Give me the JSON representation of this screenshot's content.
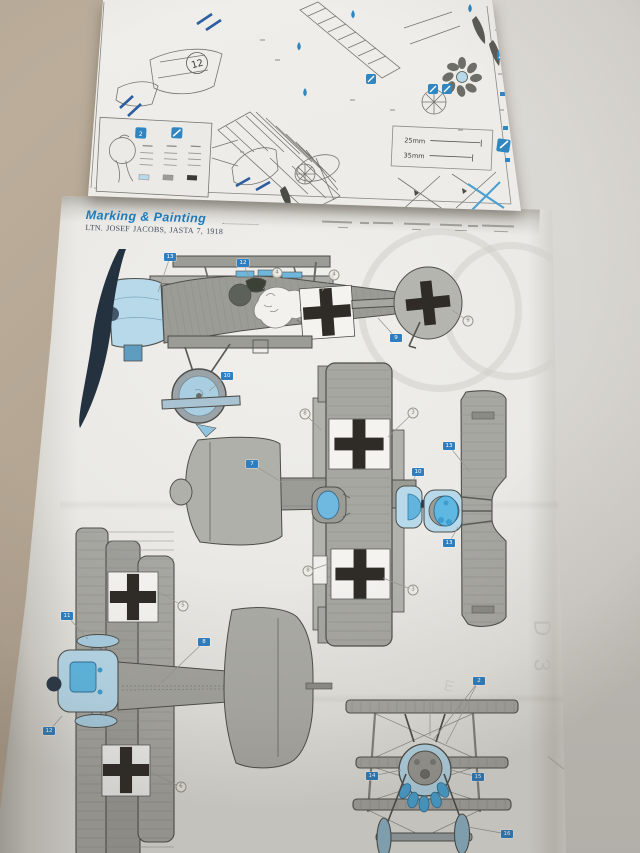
{
  "assembly_page": {
    "step_number": "12",
    "rig_len_1": "25mm",
    "rig_len_2": "35mm"
  },
  "painting_page": {
    "title": "Marking & Painting",
    "subtitle": "LTN. JOSEF JACOBS, JASTA 7, 1918",
    "ghost_marks": {
      "d3": "D 3",
      "e": "E"
    }
  },
  "legend_marks": [
    {
      "x": 322,
      "y": 221,
      "w": 30,
      "h": 2
    },
    {
      "x": 360,
      "y": 222,
      "w": 9,
      "h": 2
    },
    {
      "x": 373,
      "y": 222,
      "w": 20,
      "h": 2
    },
    {
      "x": 404,
      "y": 223,
      "w": 26,
      "h": 2
    },
    {
      "x": 440,
      "y": 224,
      "w": 22,
      "h": 2
    },
    {
      "x": 468,
      "y": 225,
      "w": 10,
      "h": 2
    },
    {
      "x": 482,
      "y": 225,
      "w": 32,
      "h": 2
    },
    {
      "x": 338,
      "y": 227,
      "w": 10,
      "h": 1
    },
    {
      "x": 412,
      "y": 229,
      "w": 9,
      "h": 1
    },
    {
      "x": 455,
      "y": 230,
      "w": 12,
      "h": 1
    },
    {
      "x": 494,
      "y": 231,
      "w": 14,
      "h": 1
    }
  ],
  "callouts": [
    {
      "t": "box",
      "label": "13",
      "x": 170,
      "y": 257,
      "lx": 158,
      "ly": 292
    },
    {
      "t": "box",
      "label": "12",
      "x": 243,
      "y": 263,
      "lx": 249,
      "ly": 277
    },
    {
      "t": "box",
      "label": "9",
      "x": 396,
      "y": 338,
      "lx": 378,
      "ly": 318
    },
    {
      "t": "box",
      "label": "10",
      "x": 227,
      "y": 376,
      "lx": 209,
      "ly": 391
    },
    {
      "t": "box",
      "label": "7",
      "x": 252,
      "y": 464,
      "lx": 288,
      "ly": 486
    },
    {
      "t": "box",
      "label": "13",
      "x": 449,
      "y": 446,
      "lx": 470,
      "ly": 472
    },
    {
      "t": "box",
      "label": "13",
      "x": 449,
      "y": 543,
      "lx": 458,
      "ly": 527
    },
    {
      "t": "box",
      "label": "10",
      "x": 418,
      "y": 472,
      "lx": 409,
      "ly": 487
    },
    {
      "t": "box",
      "label": "11",
      "x": 67,
      "y": 616,
      "lx": 88,
      "ly": 639
    },
    {
      "t": "box",
      "label": "8",
      "x": 204,
      "y": 642,
      "lx": 161,
      "ly": 683
    },
    {
      "t": "box",
      "label": "12",
      "x": 49,
      "y": 731,
      "lx": 62,
      "ly": 716
    },
    {
      "t": "box",
      "label": "2",
      "x": 479,
      "y": 681,
      "lx": 433,
      "ly": 740
    },
    {
      "t": "box",
      "label": "14",
      "x": 372,
      "y": 776,
      "lx": 401,
      "ly": 770
    },
    {
      "t": "box",
      "label": "15",
      "x": 478,
      "y": 777,
      "lx": 451,
      "ly": 770
    },
    {
      "t": "box",
      "label": "16",
      "x": 507,
      "y": 834,
      "lx": 468,
      "ly": 827
    },
    {
      "t": "circ",
      "label": "4",
      "x": 277,
      "y": 273,
      "lx": 263,
      "ly": 289
    },
    {
      "t": "circ",
      "label": "4",
      "x": 334,
      "y": 275,
      "lx": 322,
      "ly": 291
    },
    {
      "t": "circ",
      "label": "9",
      "x": 468,
      "y": 321,
      "lx": 452,
      "ly": 310
    },
    {
      "t": "circ",
      "label": "8",
      "x": 305,
      "y": 414,
      "lx": 321,
      "ly": 430
    },
    {
      "t": "circ",
      "label": "3",
      "x": 413,
      "y": 413,
      "lx": 388,
      "ly": 437
    },
    {
      "t": "circ",
      "label": "8",
      "x": 308,
      "y": 571,
      "lx": 328,
      "ly": 564
    },
    {
      "t": "circ",
      "label": "3",
      "x": 413,
      "y": 590,
      "lx": 383,
      "ly": 578
    },
    {
      "t": "circ",
      "label": "5",
      "x": 183,
      "y": 606,
      "lx": 159,
      "ly": 592
    },
    {
      "t": "circ",
      "label": "6",
      "x": 181,
      "y": 787,
      "lx": 150,
      "ly": 772
    }
  ],
  "extra_leaders": [
    {
      "x1": 476,
      "y1": 686,
      "x2": 446,
      "y2": 744
    },
    {
      "x1": 430,
      "y1": 700,
      "x2": 430,
      "y2": 736
    }
  ],
  "palette": {
    "surface_tan": "#b3a492",
    "paper": "#eae9e5",
    "header_blue": "#1d7cbd",
    "callout_blue": "#2f7fc0",
    "aircraft_grey": "#9c9c97",
    "aircraft_light_grey": "#b2b2ad",
    "cowl_light_blue": "#b7d9ea",
    "engine_blue": "#5fb8e2",
    "propeller_navy": "#24313f",
    "cross_black": "#2f2b26",
    "cross_field_white": "#f4f3f0"
  },
  "icons": [
    "paint-drop-icon",
    "paint-brush-icon",
    "step-number-badge",
    "national-cross-marking"
  ]
}
